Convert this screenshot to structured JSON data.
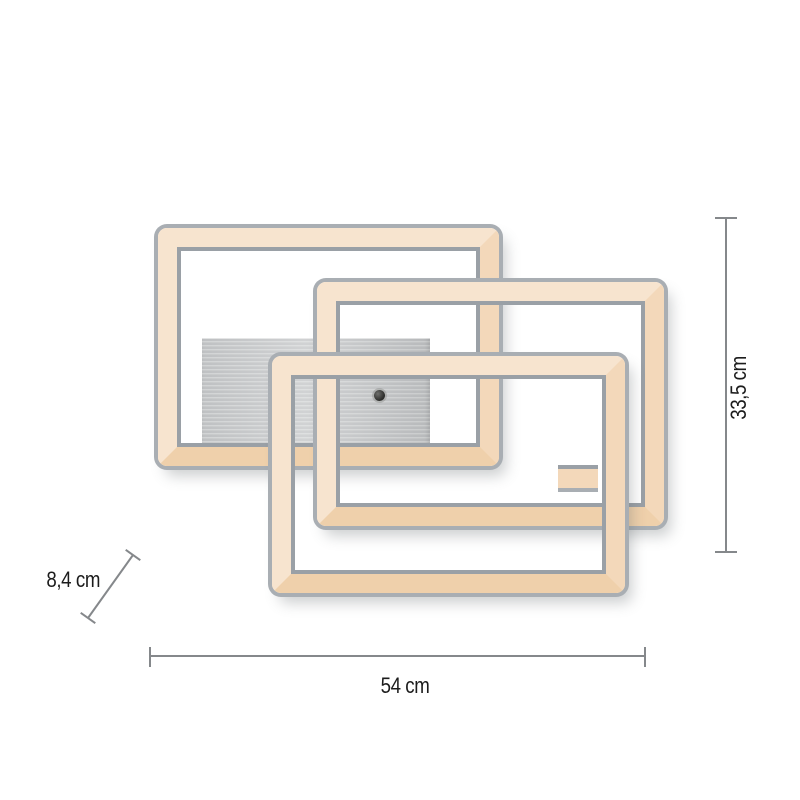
{
  "product": {
    "kind": "ceiling-light-dimension-diagram",
    "frames": 3,
    "style": "interlocking rectangular LED frames on a brushed aluminium canopy"
  },
  "dimensions": {
    "width": {
      "label": "54 cm"
    },
    "height": {
      "label": "33,5 cm"
    },
    "depth": {
      "label": "8,4 cm"
    }
  },
  "colors": {
    "chrome": "#a9aeb3",
    "chromeDark": "#9aa0a6",
    "led": "#f3d8ba",
    "ledLight": "#f7e4cf",
    "ledDeep": "#efd0ab",
    "plate": "#c7c9ca",
    "plateDark": "#bfc1c3",
    "line": "#85888b",
    "text": "#1c1c1c"
  }
}
